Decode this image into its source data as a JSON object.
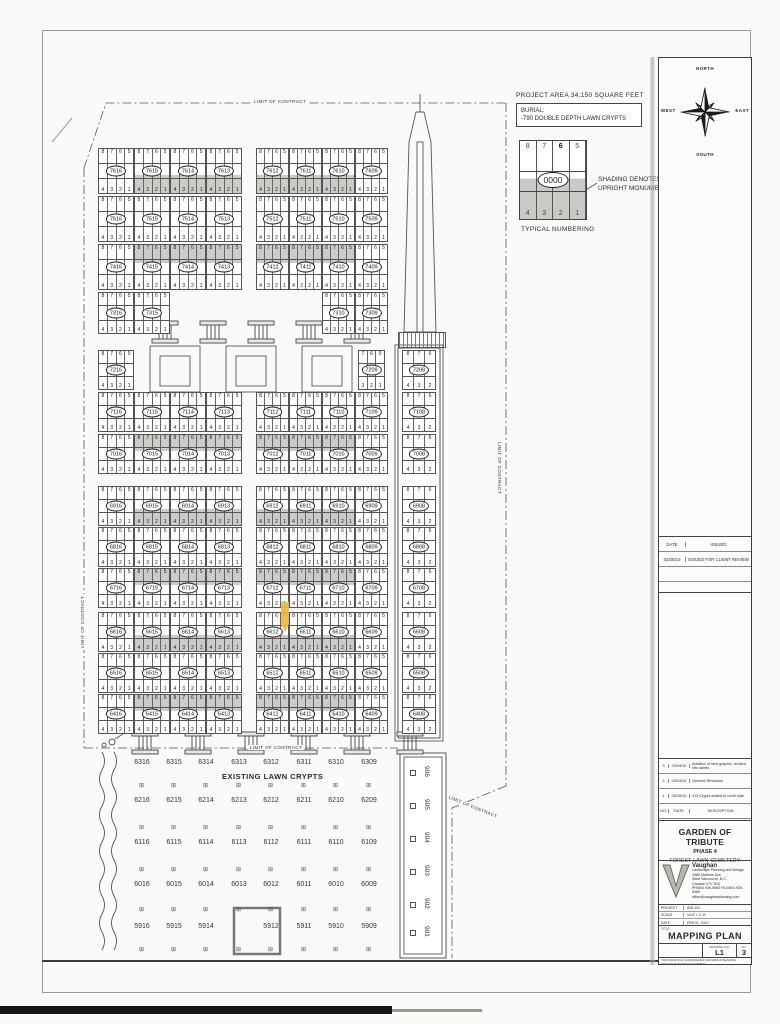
{
  "sheet": {
    "compass": {
      "north": "NORTH",
      "south": "SOUTH",
      "east": "EAST",
      "west": "WEST"
    },
    "legend": {
      "project_area": "PROJECT AREA 34,150 SQUARE FEET",
      "burial_line1": "BURIAL:",
      "burial_line2": "-790 DOUBLE DEPTH LAWN CRYPTS",
      "typical_top": [
        "8",
        "7",
        "6",
        "5"
      ],
      "typical_bottom": [
        "4",
        "3",
        "2",
        "1"
      ],
      "typical_oval": "0000",
      "shading_note_line1": "SHADING DENOTES",
      "shading_note_line2": "UPRIGHT MONUMENTS",
      "typical_caption": "TYPICAL NUMBERING"
    },
    "limit_labels": [
      {
        "text": "LIMIT OF CONTRACT",
        "x": 252,
        "y": 99,
        "r": 0
      },
      {
        "text": "LIMIT OF CONTRACT",
        "x": 502,
        "y": 440,
        "r": 90
      },
      {
        "text": "LIMIT OF CONTRACT",
        "x": 80,
        "y": 650,
        "r": -90
      },
      {
        "text": "LIMIT OF CONTRACT",
        "x": 248,
        "y": 745,
        "r": 0
      },
      {
        "text": "LIMIT OF CONTRACT",
        "x": 448,
        "y": 794,
        "r": 22
      }
    ]
  },
  "plan": {
    "cell_top": [
      "8",
      "7",
      "6",
      "5"
    ],
    "cell_bottom": [
      "4",
      "3",
      "2",
      "1"
    ],
    "strip_top": [
      "8",
      "7",
      "6"
    ],
    "strip_bottom": [
      "4",
      "3",
      "2"
    ],
    "rows": [
      {
        "y": 148,
        "h": 46,
        "shade": "bottom",
        "groups": [
          {
            "x": 98,
            "w": 36,
            "plots": [
              "7616",
              "7615*",
              "7614*",
              "7613*"
            ]
          },
          {
            "x": 256,
            "w": 33,
            "plots": [
              "7612*",
              "7611*",
              "7610*",
              "7609"
            ]
          }
        ]
      },
      {
        "y": 196,
        "h": 46,
        "shade": null,
        "groups": [
          {
            "x": 98,
            "w": 36,
            "plots": [
              "7516",
              "7515",
              "7514",
              "7513"
            ]
          },
          {
            "x": 256,
            "w": 33,
            "plots": [
              "7512",
              "7511",
              "7510",
              "7509"
            ]
          }
        ]
      },
      {
        "y": 244,
        "h": 46,
        "shade": "top",
        "groups": [
          {
            "x": 98,
            "w": 36,
            "plots": [
              "7416",
              "7415*",
              "7414*",
              "7413*"
            ]
          },
          {
            "x": 256,
            "w": 33,
            "plots": [
              "7412*",
              "7411*",
              "7410*",
              "7409"
            ]
          }
        ]
      },
      {
        "y": 292,
        "h": 42,
        "shade": null,
        "groups": [
          {
            "x": 98,
            "w": 36,
            "plots": [
              "7316",
              "7315"
            ]
          },
          {
            "x": 322,
            "w": 33,
            "plots": [
              "7310",
              "7309"
            ]
          }
        ]
      },
      {
        "y": 350,
        "h": 40,
        "shade": null,
        "groups": [
          {
            "x": 98,
            "w": 36,
            "plots": [
              "7216"
            ]
          },
          {
            "x": 358,
            "w": 27,
            "plots": [
              "7209"
            ],
            "top": [
              "7",
              "6",
              "5"
            ],
            "bot": [
              "3",
              "2",
              "1"
            ]
          }
        ]
      },
      {
        "y": 392,
        "h": 40,
        "shade": null,
        "groups": [
          {
            "x": 98,
            "w": 36,
            "plots": [
              "7116",
              "7115",
              "7114",
              "7113"
            ]
          },
          {
            "x": 256,
            "w": 33,
            "plots": [
              "7112",
              "7111",
              "7110",
              "7109"
            ]
          }
        ]
      },
      {
        "y": 434,
        "h": 40,
        "shade": "top",
        "groups": [
          {
            "x": 98,
            "w": 36,
            "plots": [
              "7016",
              "7015*",
              "7014*",
              "7013*"
            ]
          },
          {
            "x": 256,
            "w": 33,
            "plots": [
              "7012*",
              "7011*",
              "7010*",
              "7009"
            ]
          }
        ]
      },
      {
        "y": 486,
        "h": 40,
        "shade": "bottom",
        "groups": [
          {
            "x": 98,
            "w": 36,
            "plots": [
              "6916",
              "6915*",
              "6914*",
              "6913*"
            ]
          },
          {
            "x": 256,
            "w": 33,
            "plots": [
              "6912*",
              "6911*",
              "6910*",
              "6909"
            ]
          }
        ]
      },
      {
        "y": 527,
        "h": 40,
        "shade": null,
        "groups": [
          {
            "x": 98,
            "w": 36,
            "plots": [
              "6816",
              "6815",
              "6814",
              "6813"
            ]
          },
          {
            "x": 256,
            "w": 33,
            "plots": [
              "6812",
              "6811",
              "6810",
              "6809"
            ]
          }
        ]
      },
      {
        "y": 568,
        "h": 40,
        "shade": "top",
        "groups": [
          {
            "x": 98,
            "w": 36,
            "plots": [
              "6716",
              "6715*",
              "6714*",
              "6713*"
            ]
          },
          {
            "x": 256,
            "w": 33,
            "plots": [
              "6712*",
              "6711*",
              "6710*",
              "6709"
            ]
          }
        ]
      },
      {
        "y": 612,
        "h": 40,
        "shade": "bottom",
        "groups": [
          {
            "x": 98,
            "w": 36,
            "plots": [
              "6616",
              "6615*",
              "6614*",
              "6613*"
            ]
          },
          {
            "x": 256,
            "w": 33,
            "plots": [
              "6612*",
              "6611*",
              "6610*",
              "6609"
            ]
          }
        ]
      },
      {
        "y": 653,
        "h": 40,
        "shade": null,
        "groups": [
          {
            "x": 98,
            "w": 36,
            "plots": [
              "6516",
              "6515",
              "6514",
              "6513"
            ]
          },
          {
            "x": 256,
            "w": 33,
            "plots": [
              "6512",
              "6511",
              "6510",
              "6509"
            ]
          }
        ]
      },
      {
        "y": 694,
        "h": 40,
        "shade": "top",
        "groups": [
          {
            "x": 98,
            "w": 36,
            "plots": [
              "6416",
              "6415*",
              "6414*",
              "6413*"
            ]
          },
          {
            "x": 256,
            "w": 33,
            "plots": [
              "6412*",
              "6411*",
              "6410*",
              "6409"
            ]
          }
        ]
      }
    ],
    "right_strip": {
      "x": 402,
      "w": 34,
      "ys": [
        350,
        392,
        434,
        486,
        527,
        568,
        612,
        653,
        694
      ],
      "plots": [
        "7208",
        "7108",
        "7008",
        "6908",
        "6808",
        "6708",
        "6608",
        "6508",
        "6408"
      ]
    },
    "pedestals": [
      {
        "y": 321,
        "xs": [
          152,
          200,
          248,
          296,
          344
        ]
      },
      {
        "y": 732,
        "xs": [
          132,
          185,
          238,
          291,
          344,
          397
        ]
      }
    ],
    "existing": {
      "title": "EXISTING LAWN CRYPTS",
      "xs": [
        142,
        174,
        206,
        239,
        271,
        304,
        336,
        369
      ],
      "ys": [
        763,
        801,
        843,
        885,
        927
      ],
      "marker_ys": [
        786,
        828,
        870,
        910,
        950
      ],
      "rows": [
        [
          "6316",
          "6315",
          "6314",
          "6313",
          "6312",
          "6311",
          "6310",
          "6309"
        ],
        [
          "6216",
          "6215",
          "6214",
          "6213",
          "6212",
          "6211",
          "6210",
          "6209"
        ],
        [
          "6116",
          "6115",
          "6114",
          "6113",
          "6112",
          "6111",
          "6110",
          "6109"
        ],
        [
          "6016",
          "6015",
          "6014",
          "6013",
          "6012",
          "6011",
          "6010",
          "6009"
        ],
        [
          "5916",
          "5915",
          "5914",
          "",
          "5912",
          "5911",
          "5910",
          "5909"
        ]
      ]
    },
    "side_strip": {
      "x": 430,
      "ys": [
        766,
        799,
        832,
        865,
        898,
        926
      ],
      "labels": [
        "906",
        "905",
        "904",
        "903",
        "902",
        "901"
      ]
    },
    "highlight_plot": "6612"
  },
  "title_block": {
    "issue_table": {
      "date_header": "DATE",
      "issued_header": "ISSUED",
      "rows": [
        {
          "date": "02/25/10",
          "issued": "ISSUED FOR CLIENT REVIEW"
        },
        {
          "date": "",
          "issued": ""
        },
        {
          "date": "",
          "issued": ""
        }
      ]
    },
    "revisions": [
      {
        "no": "3",
        "date": "03/04/10",
        "desc": "Addition of new graphic, revised info labels"
      },
      {
        "no": "2",
        "date": "03/04/10",
        "desc": "General Revisions"
      },
      {
        "no": "1",
        "date": "03/18/10",
        "desc": "213 Crypts added to north side"
      },
      {
        "no": "NO.",
        "date": "DATE",
        "desc": "DESCRIPTION"
      }
    ],
    "project_name": "GARDEN OF TRIBUTE",
    "project_phase": "PHASE 4",
    "project_sub": "FOREST LAWN CEMETERY",
    "firm": {
      "name": "Vaughan",
      "tagline": "Landscape Planning and Design",
      "addr1": "3380 Mathers Ave.",
      "addr2": "West Vancouver, B.C.",
      "addr3": "Canada V7V 2K6",
      "phone": "PH/604 926-0663  FAX/604 926-0465",
      "email": "office@vaughanplanning.com"
    },
    "fields": {
      "project_label": "PROJECT",
      "project": "A09-101",
      "scale_label": "SCALE",
      "scale": "1/16\" = 1'-0\"",
      "date_label": "DATE",
      "date": "FEB 01, 2010"
    },
    "title_label": "TITLE",
    "sheet_title": "MAPPING PLAN",
    "drawing_no_label": "DRAWING NO.",
    "drawing_no": "L1",
    "sheet_no_label": "NO.",
    "sheet_no": "3",
    "disclaimer": "THIS DRAWING SUPERSEDES DRAWINGS BEARING PREVIOUS REVISION NUMBER"
  }
}
